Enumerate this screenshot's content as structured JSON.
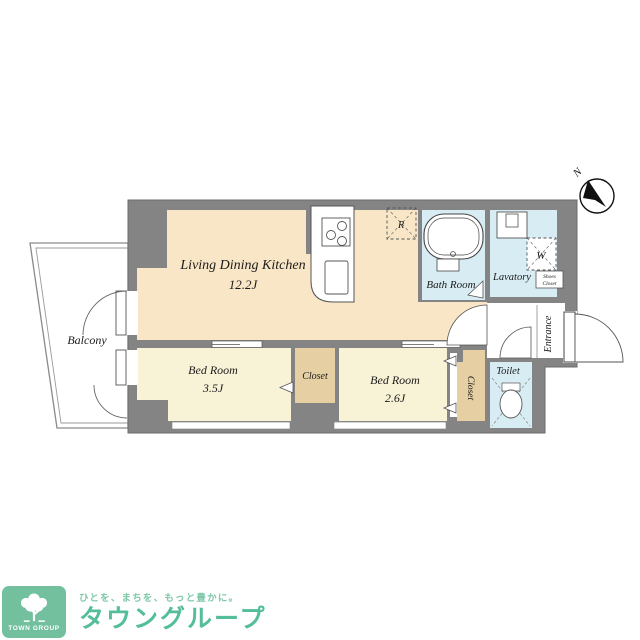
{
  "colors": {
    "wall": "#848484",
    "ldk": "#f8e6c6",
    "bedroom": "#f8f3d6",
    "closet": "#e6cfa2",
    "water": "#d8edf3",
    "line": "#4a4a4a",
    "brand-green": "#54bd9a",
    "brand-green-light": "#7ec7a8",
    "logo-box": "#72c09e"
  },
  "plan": {
    "compass_label": "N",
    "balcony": "Balcony",
    "ldk": {
      "name": "Living Dining Kitchen",
      "size": "12.2J"
    },
    "bedroom1": {
      "name": "Bed Room",
      "size": "3.5J"
    },
    "bedroom2": {
      "name": "Bed Room",
      "size": "2.6J"
    },
    "closet_middle": "Closet",
    "closet_bedroom2": "Closet",
    "bath": "Bath Room",
    "lavatory": "Lavatory",
    "toilet": "Toilet",
    "entrance": "Entrance",
    "shoes_closet": {
      "line1": "Shoes",
      "line2": "Closet"
    },
    "washer_label": "W",
    "fridge_label": "R"
  },
  "footer": {
    "badge_text": "TOWN GROUP",
    "tagline": "ひとを、まちを、もっと豊かに。",
    "brand": "タウングループ"
  }
}
